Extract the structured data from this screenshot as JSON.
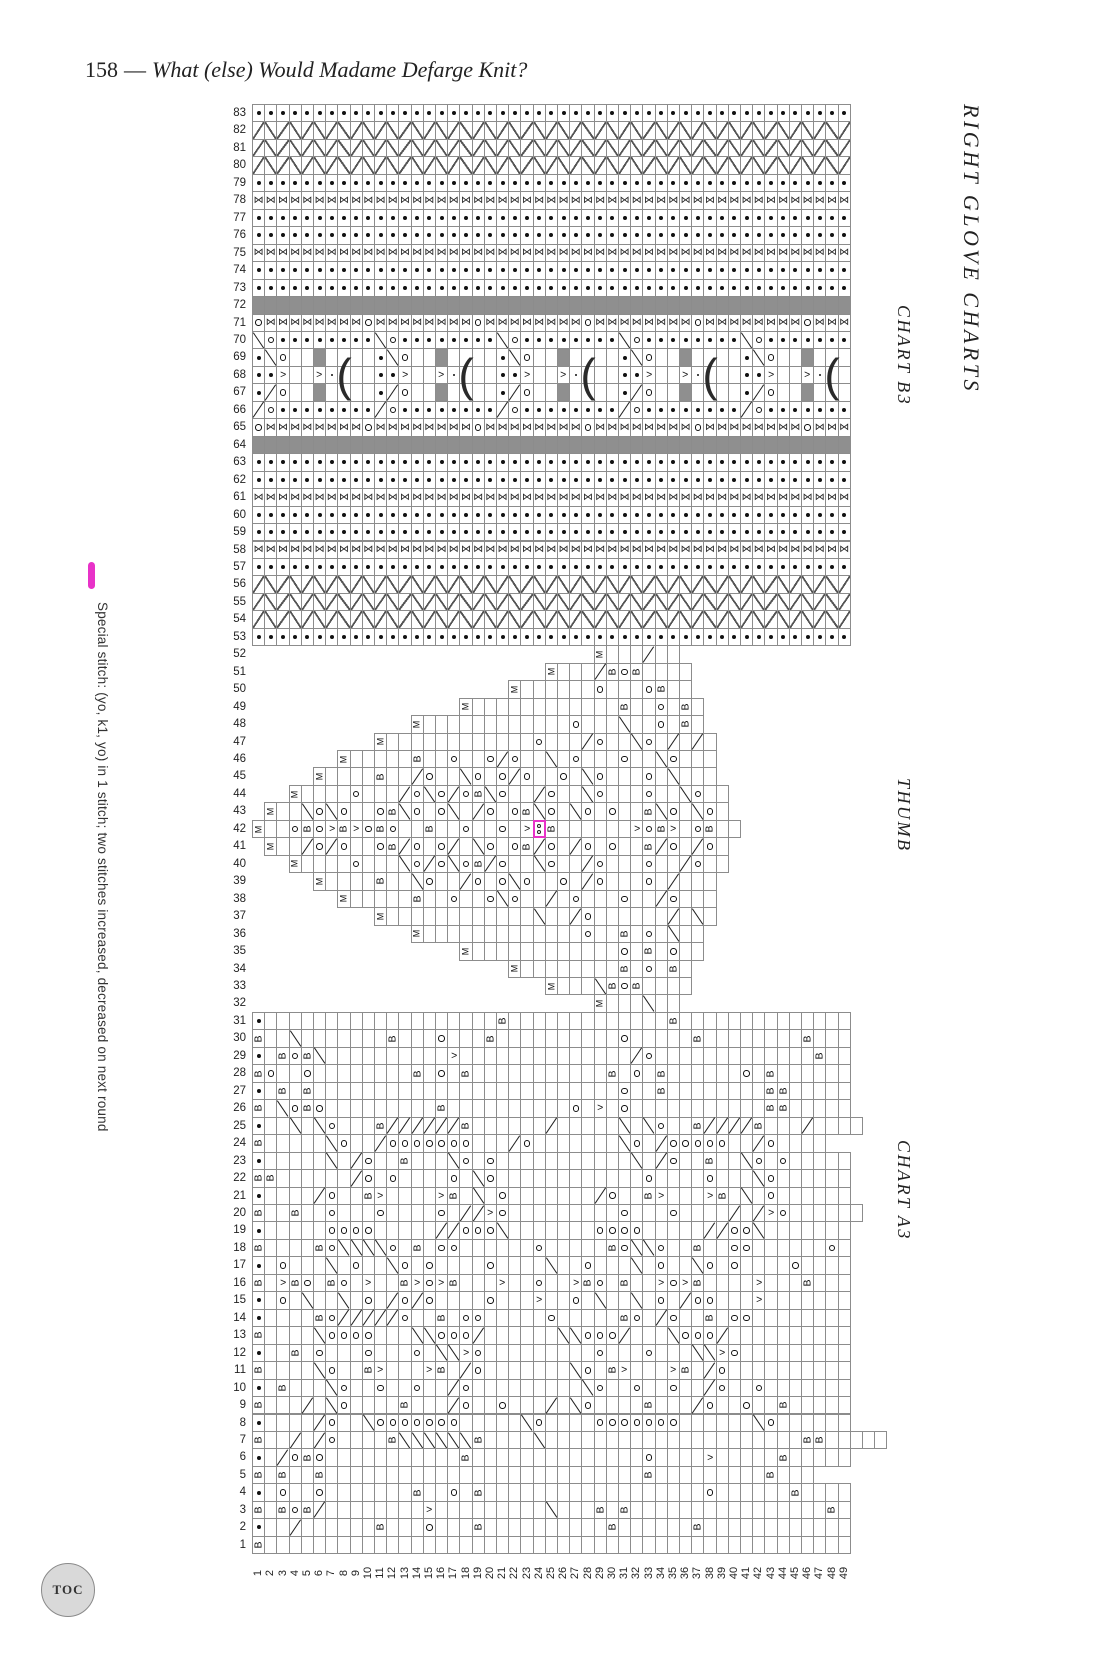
{
  "page": {
    "number": "158",
    "separator": "—",
    "title": "What (else) Would Madame Defarge Knit?"
  },
  "side_labels": {
    "main": "RIGHT GLOVE CHARTS",
    "b3": "CHART B3",
    "thumb": "THUMB",
    "a3": "CHART A3"
  },
  "legend": {
    "swatch_color": "#e832c8",
    "text": "Special stitch:  (yo, k1, yo) in 1 stitch; two stitches increased, decreased on next round"
  },
  "toc": {
    "label": "TOC"
  },
  "colors": {
    "magenta": "#e832c8",
    "grid_line": "#8c8c8c",
    "no_stitch_gray": "#8f8f8f",
    "symbol": "#111111",
    "paper": "#ffffff"
  },
  "grid": {
    "cols": 49,
    "rows": 83,
    "row_label_range": [
      1,
      83
    ],
    "col_label_range": [
      1,
      49
    ]
  },
  "symbols_legend": {
    "p": "purl-dot",
    "o": "yarn-over-circle",
    "t": "twist-bowtie",
    "g": "gray-no-stitch",
    "z": "cable-diagonal",
    "B": "bobble-letter-B",
    "M": "make-one-letter-M",
    "slash": "right-decrease",
    "backslash": "left-decrease",
    "paren": "gather-3-rows",
    "s": "center-dot",
    "gt": "point-right-marker",
    "Y": "special-stitch-(yo,k1,yo)"
  },
  "special_cell": {
    "chart": "thumb",
    "row": 42,
    "col": 24
  },
  "charts": {
    "b3": {
      "label": "CHART B3",
      "rows": [
        {
          "r": 83,
          "s": 1,
          "c": "ppppppppppppppppppppppppppppppppppppppppppppppppp"
        },
        {
          "r": 82,
          "s": 1,
          "c": "zzzzzzzzzzzzzzzzzzzzzzzzzzzzzzzzzzzzzzzzzzzzzzzzz"
        },
        {
          "r": 81,
          "s": 1,
          "c": "zzzzzzzzzzzzzzzzzzzzzzzzzzzzzzzzzzzzzzzzzzzzzzzzz"
        },
        {
          "r": 80,
          "s": 1,
          "c": "zzzzzzzzzzzzzzzzzzzzzzzzzzzzzzzzzzzzzzzzzzzzzzzzz"
        },
        {
          "r": 79,
          "s": 1,
          "c": "ppppppppppppppppppppppppppppppppppppppppppppppppp"
        },
        {
          "r": 78,
          "s": 1,
          "c": "ttttttttttttttttttttttttttttttttttttttttttttttttt"
        },
        {
          "r": 77,
          "s": 1,
          "c": "ppppppppppppppppppppppppppppppppppppppppppppppppp"
        },
        {
          "r": 76,
          "s": 1,
          "c": "ppppppppppppppppppppppppppppppppppppppppppppppppp"
        },
        {
          "r": 75,
          "s": 1,
          "c": "ttttttttttttttttttttttttttttttttttttttttttttttttt"
        },
        {
          "r": 74,
          "s": 1,
          "c": "ppppppppppppppppppppppppppppppppppppppppppppppppp"
        },
        {
          "r": 73,
          "s": 1,
          "c": "ppppppppppppppppppppppppppppppppppppppppppppppppp"
        },
        {
          "r": 72,
          "s": 1,
          "c": "ggggggggggggggggggggggggggggggggggggggggggggggggg"
        },
        {
          "r": 71,
          "s": 1,
          "c": "ottttttttottttttttottttttttottttttttottttttttottt"
        },
        {
          "r": 70,
          "s": 1,
          "c": "\\opppppppp\\opppppppp\\opppppppp\\opppppppp\\oppppppp"
        },
        {
          "r": 69,
          "s": 1,
          "c": "p\\o..g....p\\o..g....p\\o..g....p\\o..g....p\\o..g..."
        },
        {
          "r": 68,
          "s": 1,
          "c": "pp>..>s(..pp>..>s(..pp>..>s(..pp>..>s(..pp>..>s(."
        },
        {
          "r": 67,
          "s": 1,
          "c": "p/o..g....p/o..g....p/o..g....p/o..g....p/o..g..."
        },
        {
          "r": 66,
          "s": 1,
          "c": "/opppppppp/opppppppp/opppppppp/opppppppp/oppppppp"
        },
        {
          "r": 65,
          "s": 1,
          "c": "ottttttttottttttttottttttttottttttttottttttttottt"
        },
        {
          "r": 64,
          "s": 1,
          "c": "ggggggggggggggggggggggggggggggggggggggggggggggggg"
        },
        {
          "r": 63,
          "s": 1,
          "c": "ppppppppppppppppppppppppppppppppppppppppppppppppp"
        },
        {
          "r": 62,
          "s": 1,
          "c": "ppppppppppppppppppppppppppppppppppppppppppppppppp"
        },
        {
          "r": 61,
          "s": 1,
          "c": "ttttttttttttttttttttttttttttttttttttttttttttttttt"
        },
        {
          "r": 60,
          "s": 1,
          "c": "ppppppppppppppppppppppppppppppppppppppppppppppppp"
        },
        {
          "r": 59,
          "s": 1,
          "c": "ppppppppppppppppppppppppppppppppppppppppppppppppp"
        },
        {
          "r": 58,
          "s": 1,
          "c": "ttttttttttttttttttttttttttttttttttttttttttttttttt"
        },
        {
          "r": 57,
          "s": 1,
          "c": "ppppppppppppppppppppppppppppppppppppppppppppppppp"
        },
        {
          "r": 56,
          "s": 1,
          "c": "zzzzzzzzzzzzzzzzzzzzzzzzzzzzzzzzzzzzzzzzzzzzzzzzz"
        },
        {
          "r": 55,
          "s": 1,
          "c": "zzzzzzzzzzzzzzzzzzzzzzzzzzzzzzzzzzzzzzzzzzzzzzzzz"
        },
        {
          "r": 54,
          "s": 1,
          "c": "zzzzzzzzzzzzzzzzzzzzzzzzzzzzzzzzzzzzzzzzzzzzzzzzz"
        },
        {
          "r": 53,
          "s": 1,
          "c": "ppppppppppppppppppppppppppppppppppppppppppppppppp"
        }
      ]
    },
    "thumb": {
      "label": "THUMB",
      "rows": [
        {
          "r": 52,
          "s": 29,
          "c": "M.../.."
        },
        {
          "r": 51,
          "s": 25,
          "c": "M.../BoB...."
        },
        {
          "r": 50,
          "s": 22,
          "c": "M......o...oB.."
        },
        {
          "r": 49,
          "s": 18,
          "c": "M............B..o.B."
        },
        {
          "r": 48,
          "s": 14,
          "c": "M............o...\\..o.B."
        },
        {
          "r": 47,
          "s": 11,
          "c": "M............o.../o..\\o././."
        },
        {
          "r": 46,
          "s": 8,
          "c": "M.....B..o..o/o..\\.o...o..\\o..."
        },
        {
          "r": 45,
          "s": 6,
          "c": "M....B../o..\\o.o/o..o.\\o...o.\\..."
        },
        {
          "r": 44,
          "s": 4,
          "c": "M....o.../o\\o/oB\\o../o..\\o...o..\\o.."
        },
        {
          "r": 43,
          "s": 2,
          "c": "M..\\o\\o..oB\\o.o\\./o.oB\\o.\\o.o..B\\o.\\o."
        },
        {
          "r": 42,
          "s": 1,
          "c": "M..oBo>B>oBo..B..o..o.>YB......>oB>.oB.."
        },
        {
          "r": 41,
          "s": 2,
          "c": "M../o/o..oB/o.o/.\\o.oB/o./o.o..B/o./o."
        },
        {
          "r": 40,
          "s": 4,
          "c": "M....o...\\o/o\\oB/o..\\o../o...o../o.."
        },
        {
          "r": 39,
          "s": 6,
          "c": "M....B..\\o../o.o\\o..o./o...o./..."
        },
        {
          "r": 38,
          "s": 8,
          "c": "M.....B..o..o\\o../.o...o../o..."
        },
        {
          "r": 37,
          "s": 11,
          "c": "M............\\../o....../.\\."
        },
        {
          "r": 36,
          "s": 14,
          "c": "M.............o..B.o.\\.."
        },
        {
          "r": 35,
          "s": 18,
          "c": "M............o.B.o.."
        },
        {
          "r": 34,
          "s": 22,
          "c": "M........B.o.B."
        },
        {
          "r": 33,
          "s": 25,
          "c": "M...\\BoB...."
        },
        {
          "r": 32,
          "s": 29,
          "c": "M...\\.."
        }
      ]
    },
    "a3": {
      "label": "CHART A3",
      "rows": [
        {
          "r": 31,
          "s": 1,
          "c": "p...................B.............B.............."
        },
        {
          "r": 30,
          "s": 1,
          "c": "B..\\.......B...o...B..........o.....B........B..."
        },
        {
          "r": 29,
          "s": 1,
          "c": "p.BoB\\..........>............../o.............B.."
        },
        {
          "r": 28,
          "s": 1,
          "c": "Bo..o........B.o.B...........B.o.B......o.B......"
        },
        {
          "r": 27,
          "s": 1,
          "c": "p.B.B.........................o..B........BB....."
        },
        {
          "r": 26,
          "s": 1,
          "c": "B.\\oBo.........B..........o.>.o...........BB....."
        },
        {
          "r": 25,
          "s": 1,
          "c": "p..\\.\\o...B//////B....../.....\\.\\o..B////B.../...."
        },
        {
          "r": 24,
          "s": 1,
          "c": "B.....\\o../ooooooo.../o.......\\o./ooooo../o...."
        },
        {
          "r": 23,
          "s": 1,
          "c": "p.....\\./o..B...\\o.o...........\\./o..B..\\o.o....."
        },
        {
          "r": 22,
          "s": 1,
          "c": "BB....../o.o....o.\\o............o....o...\\o......"
        },
        {
          "r": 21,
          "s": 1,
          "c": "p..../o..B>....>B.\\.o......./o..B>...>B.\\.o......"
        },
        {
          "r": 20,
          "s": 1,
          "c": "B..B..o...o....o.//>o.........o...o..../​/>o......"
        },
        {
          "r": 19,
          "s": 1,
          "c": "p.....oooo.....//ooo\\.......oooo.....//oo\\......."
        },
        {
          "r": 18,
          "s": 1,
          "c": "B....Bo\\\\\\\\o.B.oo......o.....Bo\\\\o..B..oo......o."
        },
        {
          "r": 17,
          "s": 1,
          "c": "p.o...\\.o..\\o.o....o....\\..o...\\.o..\\o.o....o...."
        },
        {
          "r": 16,
          "s": 1,
          "c": "B.>Bo.Bo.>..B>o>B...>..o..>Bo.B..>o>B....>...B..."
        },
        {
          "r": 15,
          "s": 1,
          "c": "p.o.\\..\\.o./o/o....o...>..o.\\..\\.o./oo...>......."
        },
        {
          "r": 14,
          "s": 1,
          "c": "p....Bo/////o..B.oo.....o.....Bo./o..B.oo........"
        },
        {
          "r": 13,
          "s": 1,
          "c": "B....\\oooo...\\\\ooo/......\\\\ooo/...\\ooo/.........."
        },
        {
          "r": 12,
          "s": 1,
          "c": "p..B.o...o...o.\\\\>o.........o...o...\\\\>o........."
        },
        {
          "r": 11,
          "s": 1,
          "c": "B....\\o..B>...>B./o.......\\o.B>...>B./o.........."
        },
        {
          "r": 10,
          "s": 1,
          "c": "p.B...\\o..o..o../o.........\\o..o..o../o..o......."
        },
        {
          "r": 9,
          "s": 1,
          "c": "B.../.\\o....B.../o..o.../.\\o....B.../o..o..B....."
        },
        {
          "r": 8,
          "s": 1,
          "c": "p..../o..\\ooooooo.....\\o....ooooooo......\\o......"
        },
        {
          "r": 7,
          "s": 1,
          "c": "B.././o....B\\\\\\\\\\\\B....\\.....................BB....."
        },
        {
          "r": 6,
          "s": 1,
          "c": "p./oBo...........B..............o....>.....B....."
        },
        {
          "r": 5,
          "s": 1,
          "c": "B.B..B..........................B.........B..."
        },
        {
          "r": 4,
          "s": 1,
          "c": "p.o..o.......B..o.B..................o......B...."
        },
        {
          "r": 3,
          "s": 1,
          "c": "B.BoB/........>.........\\...B.B................B."
        },
        {
          "r": 2,
          "s": 1,
          "c": "p../......B...o...B..........B......B............"
        },
        {
          "r": 1,
          "s": 1,
          "c": "B................................................"
        }
      ]
    }
  }
}
